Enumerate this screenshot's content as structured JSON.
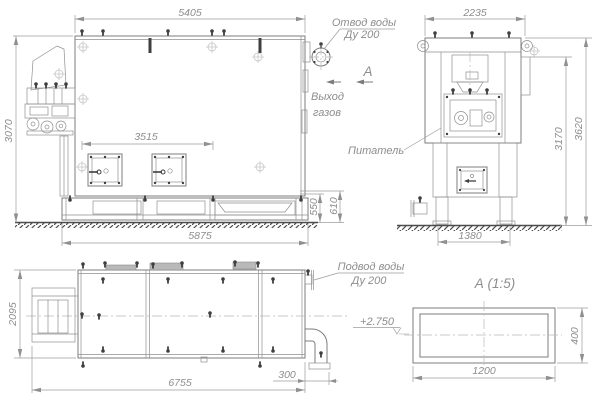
{
  "front": {
    "dim_top": "5405",
    "dim_height": "3070",
    "dim_doors": "3515",
    "dim_bottom": "5875",
    "dim_base1": "550",
    "dim_base2": "610",
    "water_outlet1": "Отвод воды",
    "water_outlet2": "Ду 200",
    "gas1": "Выход",
    "gas2": "газов",
    "section_letter": "А"
  },
  "side": {
    "dim_top": "2235",
    "dim_h1": "3170",
    "dim_h2": "3620",
    "dim_base": "1380",
    "feeder": "Питатель"
  },
  "plan": {
    "dim_height": "2095",
    "dim_length": "6755",
    "dim_pipe": "300",
    "water_inlet1": "Подвод воды",
    "water_inlet2": "Ду 200",
    "elevation": "+2.750"
  },
  "section": {
    "title": "А  (1:5)",
    "dim_w": "1200",
    "dim_h": "400"
  },
  "colors": {
    "line": "#7c7c7c",
    "dim_text": "#8d8d8d",
    "dark": "#3f3f3f",
    "background": "#ffffff"
  }
}
